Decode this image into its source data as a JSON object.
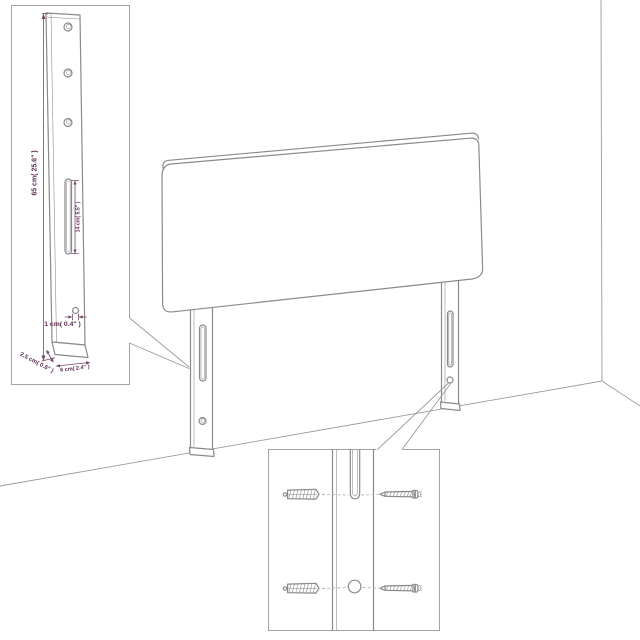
{
  "colors": {
    "background": "#ffffff",
    "outline": "#8a8a8a",
    "dimension": "#5d2b52"
  },
  "leg_detail_inset": {
    "height_label": "65 cm( 25.6\" )",
    "slot_label": "14 cm( 5.5\" )",
    "hole_label": "1 cm( 0.4\" )",
    "foot_depth_label": "2.5 cm( 0.6\" )",
    "foot_width_label": "6 cm( 2.4\" )"
  }
}
